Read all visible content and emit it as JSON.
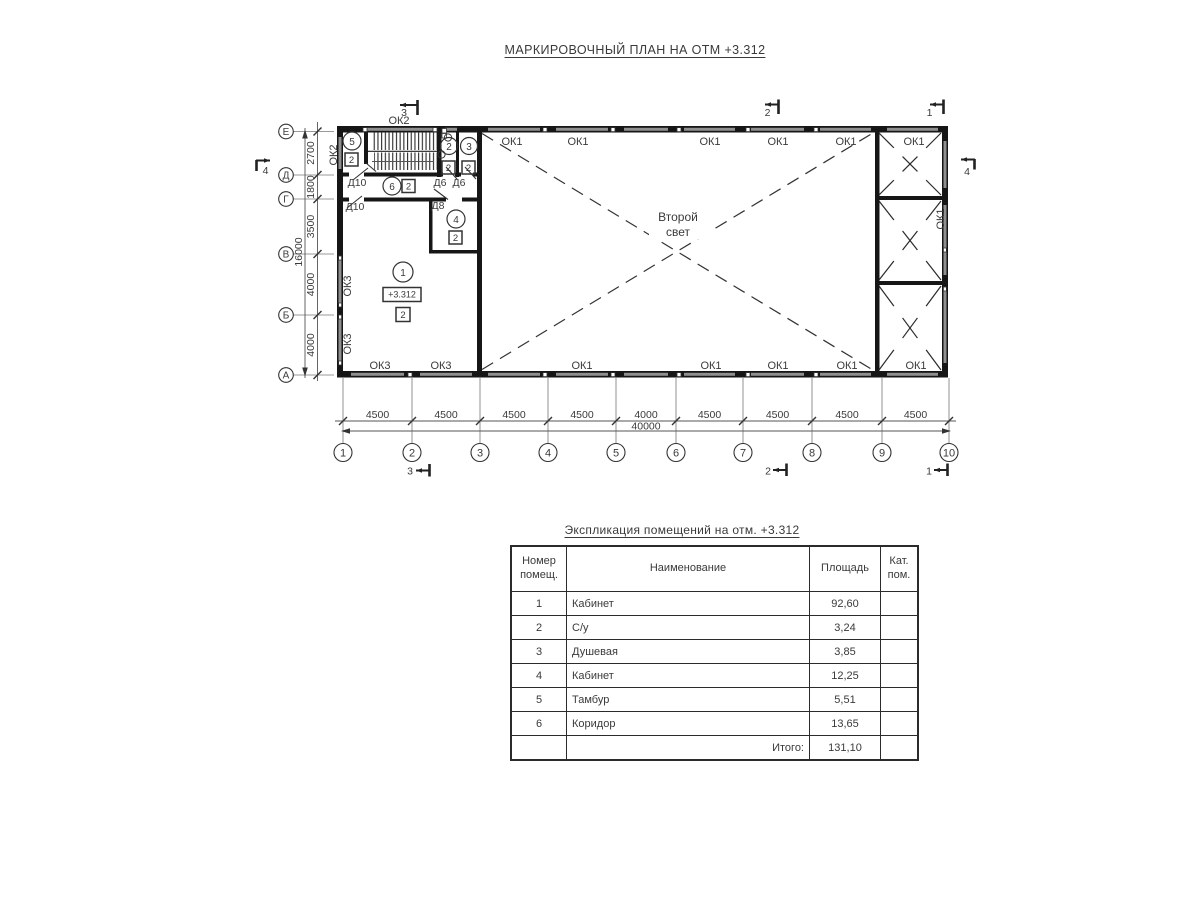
{
  "page": {
    "title": "МАРКИРОВОЧНЫЙ ПЛАН НА ОТМ +3.312"
  },
  "plan": {
    "second_light": [
      "Второй",
      "свет"
    ],
    "elevation_mark": "+3.312",
    "axes_rows": [
      "Е",
      "Д",
      "Г",
      "В",
      "Б",
      "А"
    ],
    "axes_cols": [
      "1",
      "2",
      "3",
      "4",
      "5",
      "6",
      "7",
      "8",
      "9",
      "10"
    ],
    "dims_left": [
      "2700",
      "1800",
      "3500",
      "4000",
      "4000"
    ],
    "dim_left_total": "16000",
    "dims_bottom": [
      "4500",
      "4500",
      "4500",
      "4500",
      "4000",
      "4500",
      "4500",
      "4500",
      "4500"
    ],
    "dim_bottom_total": "40000",
    "ok1_top": [
      "ОК1",
      "ОК1",
      "ОК1",
      "ОК1",
      "ОК1",
      "ОК1"
    ],
    "ok1_bottom": [
      "ОК1",
      "ОК1",
      "ОК1",
      "ОК1",
      "ОК1"
    ],
    "ok1_right": "ОК1",
    "ok2_top": "ОК2",
    "ok2_left": "ОК2",
    "ok3_left": [
      "ОК3",
      "ОК3"
    ],
    "ok3_bottom": [
      "ОК3",
      "ОК3"
    ],
    "d10": [
      "Д10",
      "Д10"
    ],
    "d6": [
      "Д6",
      "Д6"
    ],
    "d8": "Д8",
    "rooms": [
      {
        "num": "1",
        "cat": "2"
      },
      {
        "num": "2",
        "cat": "2"
      },
      {
        "num": "3",
        "cat": "2"
      },
      {
        "num": "4",
        "cat": "2"
      },
      {
        "num": "5",
        "cat": "2"
      },
      {
        "num": "6",
        "cat": "2"
      }
    ],
    "sections": {
      "mark1": "1",
      "mark2": "2",
      "mark3": "3",
      "mark4": "4"
    }
  },
  "table": {
    "title": "Экспликация помещений на отм. +3.312",
    "headers": {
      "number": "Номер помещ.",
      "name": "Наименование",
      "area": "Площадь",
      "category": "Кат. пом."
    },
    "rows": [
      {
        "num": "1",
        "name": "Кабинет",
        "area": "92,60"
      },
      {
        "num": "2",
        "name": "С/у",
        "area": "3,24"
      },
      {
        "num": "3",
        "name": "Душевая",
        "area": "3,85"
      },
      {
        "num": "4",
        "name": "Кабинет",
        "area": "12,25"
      },
      {
        "num": "5",
        "name": "Тамбур",
        "area": "5,51"
      },
      {
        "num": "6",
        "name": "Коридор",
        "area": "13,65"
      }
    ],
    "total_label": "Итого:",
    "total_value": "131,10"
  }
}
